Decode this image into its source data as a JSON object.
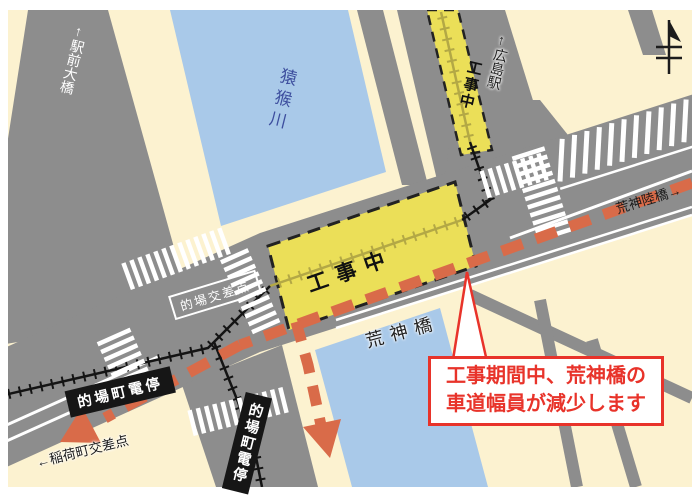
{
  "map": {
    "labels": {
      "ekimae_bridge": "←駅前大橋",
      "enko_river": "猿猴川",
      "hiroshima_station": "←広島駅",
      "under_construction_north": "工事中",
      "under_construction_main": "工事中",
      "kojin_overpass": "荒神陸橋→",
      "kojin_bridge": "荒神橋",
      "matoba_intersection": "的場交差点",
      "matoba_tram_stop_west": "的場町電停",
      "matoba_tram_stop_south": "的場町電停",
      "inarimachi_intersection": "←稲荷町交差点"
    },
    "callout": {
      "line1": "工事期間中、荒神橋の",
      "line2": "車道幅員が減少します"
    },
    "icons": {
      "north_arrow": "north-arrow"
    },
    "colors": {
      "background": "#fcf2d0",
      "road": "#8d8d8d",
      "river": "#a9c9e9",
      "construction_yellow": "#ebdf58",
      "track_olive": "#b3a845",
      "route_red": "#d96b49",
      "alert_red": "#e8332a",
      "river_label_blue": "#3d4e9e",
      "track_black": "#141414"
    }
  }
}
